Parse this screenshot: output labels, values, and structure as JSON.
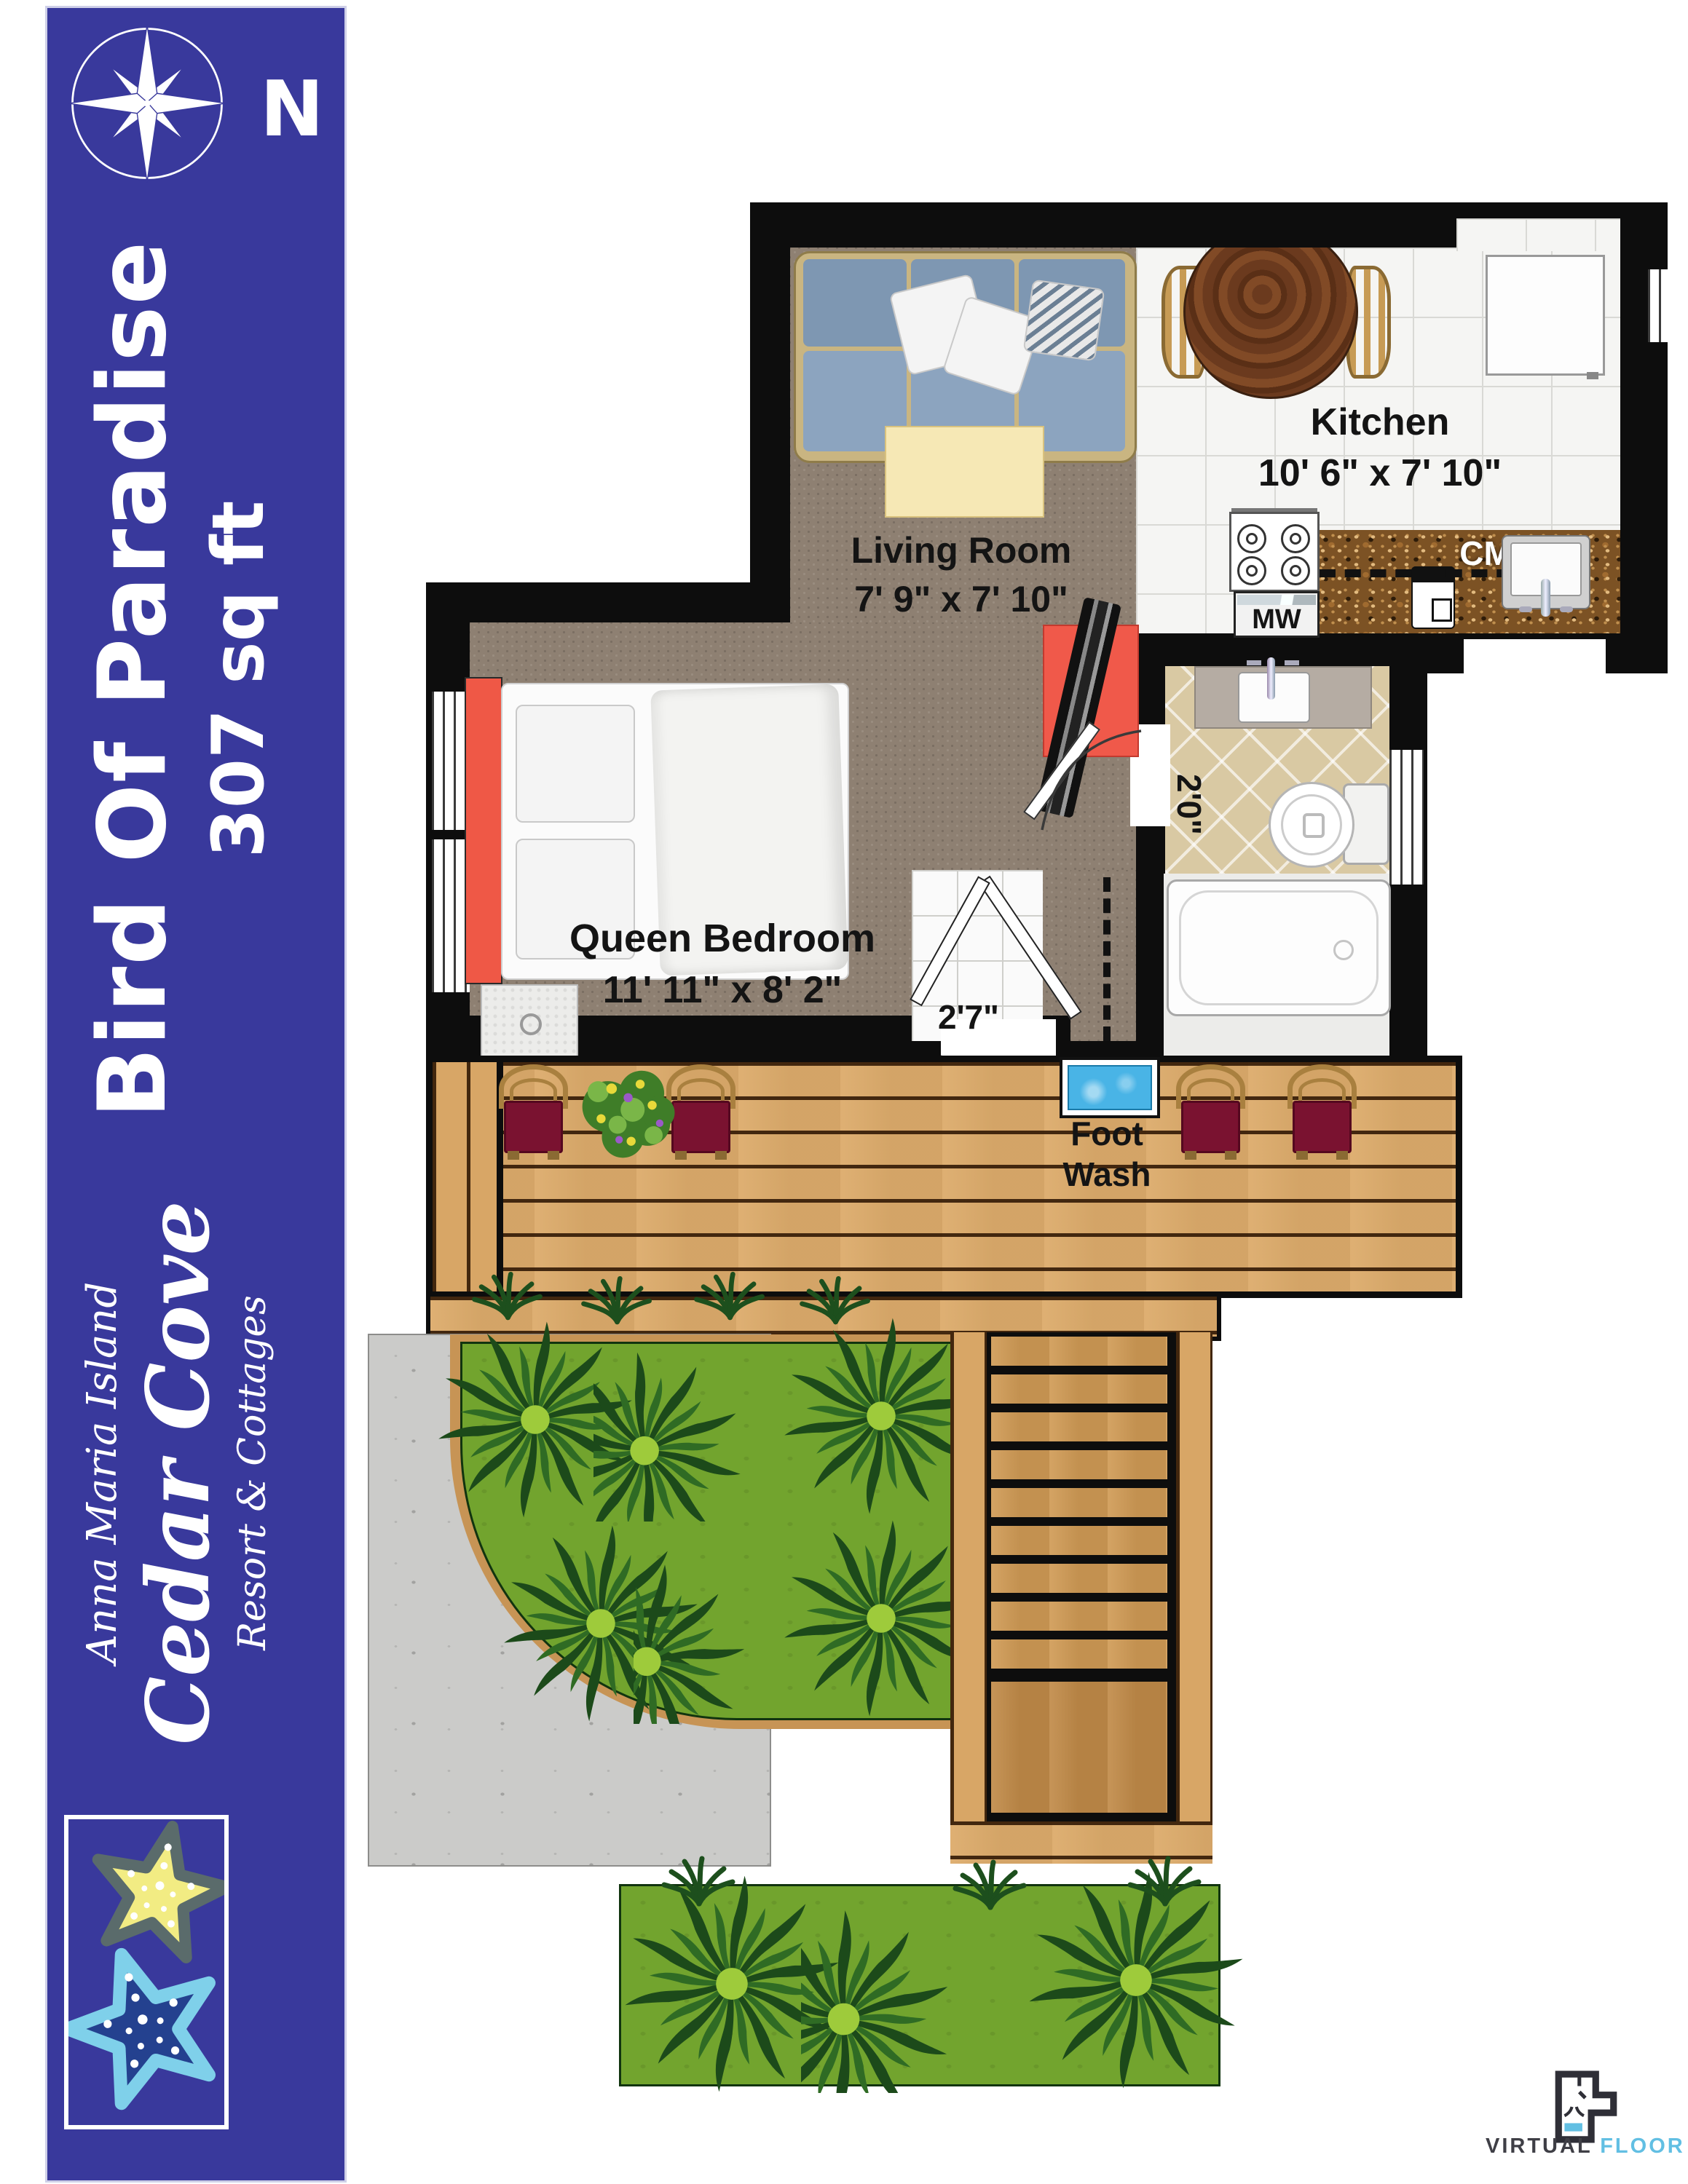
{
  "sidebar": {
    "bg_color": "#39399c",
    "compass_label": "N",
    "title": {
      "line1": "Bird Of Paradise",
      "line2": "307 sq ft"
    },
    "brand": {
      "top": "Anna Maria Island",
      "main": "Cedar Cove",
      "bottom": "Resort & Cottages"
    }
  },
  "floorplan": {
    "kitchen": {
      "name": "Kitchen",
      "dims": "10' 6\" x 7' 10\"",
      "microwave_label": "MW",
      "coffee_maker_label": "CM"
    },
    "living_room": {
      "name": "Living Room",
      "dims": "7' 9\" x 7' 10\""
    },
    "bedroom": {
      "name": "Queen Bedroom",
      "dims": "11' 11\" x 8' 2\""
    },
    "bathroom": {
      "width_label": "2'0\""
    },
    "entry": {
      "width_label": "2'7\""
    },
    "deck": {
      "foot_wash_line1": "Foot",
      "foot_wash_line2": "Wash"
    }
  },
  "footer": {
    "logo_word1": "VIRTUAL",
    "logo_word2": "FLOOR",
    "logo_word3": "PLANS",
    "accent_color": "#62bfe3"
  },
  "colors": {
    "wall": "#0d0d0d",
    "carpet": "#8e8072",
    "deck_wood": "#dcab6b",
    "headboard_red": "#ef5846",
    "foot_wash_blue": "#49b4e6"
  }
}
